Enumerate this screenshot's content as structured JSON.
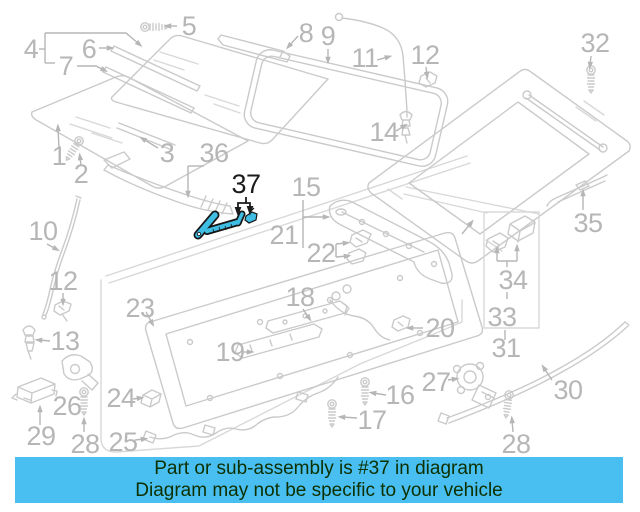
{
  "banner": {
    "line1": "Part or sub-assembly is #37 in diagram",
    "line2": "Diagram may not be specific to your vehicle",
    "bg_color": "#49bef1",
    "text_color": "#0c3000"
  },
  "highlight": {
    "part_number": "37",
    "fill": "#3fbde3",
    "outline": "#161616",
    "label_color": "#1c1c1c"
  },
  "diagram": {
    "description": "sunroof-assembly-exploded-parts-diagram",
    "line_color": "#cacaca",
    "callout_text_color": "#b6b6b6",
    "callouts": [
      {
        "n": "1",
        "x": 59,
        "y": 165,
        "leaders": [
          [
            [
              59,
              148
            ],
            [
              58,
              128
            ]
          ]
        ]
      },
      {
        "n": "2",
        "x": 81,
        "y": 183,
        "leaders": [
          [
            [
              81,
              166
            ],
            [
              80,
              157
            ]
          ]
        ]
      },
      {
        "n": "3",
        "x": 167,
        "y": 162,
        "leaders": [
          [
            [
              158,
              148
            ],
            [
              143,
              139
            ]
          ]
        ]
      },
      {
        "n": "4",
        "x": 31,
        "y": 58,
        "lines": [
          [
            [
              39,
              49
            ],
            [
              45,
              49
            ]
          ],
          [
            [
              45,
              33
            ],
            [
              45,
              63
            ]
          ],
          [
            [
              45,
              63
            ],
            [
              55,
              63
            ]
          ]
        ],
        "leaders": [
          [
            [
              45,
              33
            ],
            [
              126,
              33
            ],
            [
              139,
              44
            ]
          ]
        ]
      },
      {
        "n": "5",
        "x": 189,
        "y": 35,
        "leaders": [
          [
            [
              177,
              26
            ],
            [
              168,
              26
            ]
          ]
        ]
      },
      {
        "n": "6",
        "x": 89,
        "y": 58,
        "leaders": [
          [
            [
              99,
              48
            ],
            [
              110,
              48
            ]
          ]
        ]
      },
      {
        "n": "7",
        "x": 66,
        "y": 75,
        "leaders": [
          [
            [
              77,
              66
            ],
            [
              96,
              66
            ],
            [
              104,
              70
            ]
          ]
        ]
      },
      {
        "n": "8",
        "x": 306,
        "y": 42,
        "leaders": [
          [
            [
              298,
              36
            ],
            [
              289,
              46
            ]
          ]
        ]
      },
      {
        "n": "9",
        "x": 328,
        "y": 45,
        "leaders": [
          [
            [
              328,
              49
            ],
            [
              328,
              60
            ]
          ]
        ]
      },
      {
        "n": "10",
        "x": 43,
        "y": 240,
        "leaders": [
          [
            [
              47,
              244
            ],
            [
              56,
              249
            ]
          ]
        ]
      },
      {
        "n": "11",
        "x": 365,
        "y": 67,
        "leaders": [
          [
            [
              377,
              60
            ],
            [
              388,
              57
            ]
          ]
        ]
      },
      {
        "n": "12",
        "x": 425,
        "y": 64,
        "leaders": [
          [
            [
              426,
              67
            ],
            [
              427,
              75
            ]
          ]
        ]
      },
      {
        "n": "12",
        "x": 63,
        "y": 290,
        "leaders": [
          [
            [
              63,
              293
            ],
            [
              63,
              302
            ]
          ]
        ]
      },
      {
        "n": "13",
        "x": 65,
        "y": 350,
        "leaders": [
          [
            [
              50,
              341
            ],
            [
              39,
              340
            ]
          ]
        ]
      },
      {
        "n": "14",
        "x": 384,
        "y": 141,
        "leaders": [
          [
            [
              396,
              131
            ],
            [
              404,
              126
            ]
          ]
        ]
      },
      {
        "n": "15",
        "x": 306,
        "y": 196,
        "lines": [
          [
            [
              303,
              200
            ],
            [
              303,
              248
            ]
          ]
        ],
        "leaders": [
          [
            [
              303,
              217
            ],
            [
              326,
              217
            ]
          ]
        ]
      },
      {
        "n": "16",
        "x": 400,
        "y": 404,
        "leaders": [
          [
            [
              386,
              395
            ],
            [
              373,
              393
            ]
          ]
        ]
      },
      {
        "n": "17",
        "x": 372,
        "y": 429,
        "leaders": [
          [
            [
              357,
              418
            ],
            [
              342,
              417
            ]
          ]
        ]
      },
      {
        "n": "18",
        "x": 300,
        "y": 306,
        "leaders": [
          [
            [
              303,
              309
            ],
            [
              309,
              318
            ]
          ]
        ]
      },
      {
        "n": "19",
        "x": 230,
        "y": 361,
        "leaders": [
          [
            [
              242,
              352
            ],
            [
              250,
              352
            ]
          ]
        ]
      },
      {
        "n": "20",
        "x": 440,
        "y": 337,
        "leaders": [
          [
            [
              423,
              328
            ],
            [
              410,
              328
            ]
          ]
        ]
      },
      {
        "n": "21",
        "x": 284,
        "y": 244
      },
      {
        "n": "22",
        "x": 321,
        "y": 262,
        "lines": [
          [
            [
              336,
              244
            ],
            [
              336,
              257
            ]
          ]
        ],
        "leaders": [
          [
            [
              336,
              244
            ],
            [
              346,
              243
            ]
          ],
          [
            [
              336,
              257
            ],
            [
              347,
              256
            ]
          ]
        ]
      },
      {
        "n": "23",
        "x": 140,
        "y": 317,
        "leaders": [
          [
            [
              146,
              312
            ],
            [
              152,
              323
            ]
          ]
        ]
      },
      {
        "n": "24",
        "x": 121,
        "y": 407,
        "leaders": [
          [
            [
              133,
              399
            ],
            [
              140,
              398
            ]
          ]
        ]
      },
      {
        "n": "25",
        "x": 123,
        "y": 451,
        "leaders": [
          [
            [
              135,
              440
            ],
            [
              144,
              439
            ]
          ]
        ]
      },
      {
        "n": "26",
        "x": 67,
        "y": 415
      },
      {
        "n": "27",
        "x": 436,
        "y": 391,
        "leaders": [
          [
            [
              448,
              380
            ],
            [
              455,
              379
            ]
          ]
        ]
      },
      {
        "n": "28",
        "x": 85,
        "y": 453,
        "leaders": [
          [
            [
              84,
              432
            ],
            [
              84,
              421
            ]
          ]
        ]
      },
      {
        "n": "28",
        "x": 516,
        "y": 453,
        "leaders": [
          [
            [
              513,
              432
            ],
            [
              512,
              420
            ]
          ]
        ]
      },
      {
        "n": "29",
        "x": 41,
        "y": 445,
        "leaders": [
          [
            [
              40,
              425
            ],
            [
              40,
              409
            ]
          ]
        ]
      },
      {
        "n": "30",
        "x": 568,
        "y": 399,
        "leaders": [
          [
            [
              552,
              380
            ],
            [
              544,
              368
            ]
          ]
        ]
      },
      {
        "n": "31",
        "x": 506,
        "y": 357
      },
      {
        "n": "32",
        "x": 595,
        "y": 52,
        "leaders": [
          [
            [
              591,
              56
            ],
            [
              590,
              65
            ]
          ]
        ]
      },
      {
        "n": "33",
        "x": 502,
        "y": 326,
        "lines": [
          [
            [
              505,
              330
            ],
            [
              505,
              340
            ]
          ]
        ],
        "leaders": [
          [
            [
              462,
              234
            ],
            [
              471,
              223
            ]
          ]
        ]
      },
      {
        "n": "34",
        "x": 513,
        "y": 289,
        "lines": [
          [
            [
              497,
              261
            ],
            [
              517,
              261
            ]
          ],
          [
            [
              507,
              261
            ],
            [
              507,
              267
            ]
          ],
          [
            [
              507,
              292
            ],
            [
              507,
              299
            ]
          ]
        ],
        "leaders": [
          [
            [
              497,
              261
            ],
            [
              497,
              250
            ]
          ],
          [
            [
              517,
              261
            ],
            [
              517,
              248
            ]
          ]
        ]
      },
      {
        "n": "35",
        "x": 588,
        "y": 232,
        "leaders": [
          [
            [
              583,
              210
            ],
            [
              583,
              193
            ]
          ]
        ]
      },
      {
        "n": "36",
        "x": 214,
        "y": 162,
        "lines": [
          [
            [
              204,
              166
            ],
            [
              188,
              166
            ]
          ]
        ],
        "leaders": [
          [
            [
              188,
              166
            ],
            [
              188,
              194
            ]
          ]
        ]
      },
      {
        "n": "37",
        "x": 246,
        "y": 193,
        "black": true,
        "leaders": [
          [
            [
              246,
              197
            ],
            [
              246,
              203
            ],
            [
              238,
              203
            ],
            [
              238,
              211
            ]
          ],
          [
            [
              246,
              203
            ],
            [
              250,
              203
            ],
            [
              250,
              210
            ]
          ]
        ]
      }
    ]
  }
}
